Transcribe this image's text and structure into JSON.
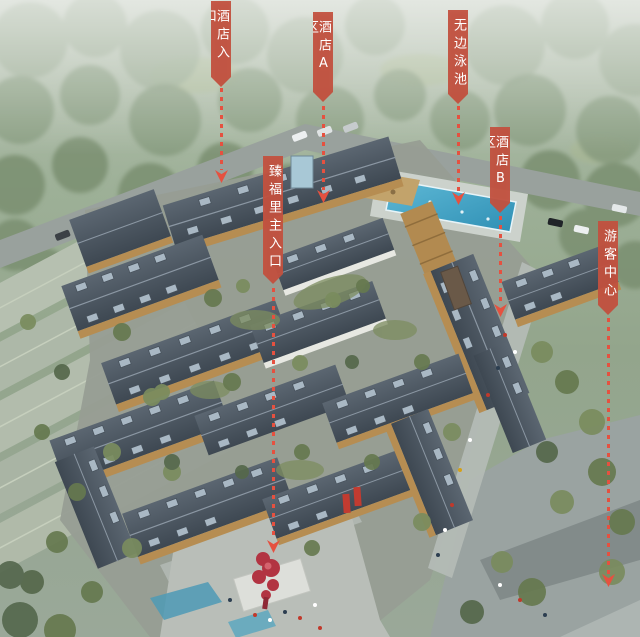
{
  "callouts": [
    {
      "id": "hotel-entrance",
      "label": "酒店入口"
    },
    {
      "id": "hotel-zone-a",
      "label": "酒店A区"
    },
    {
      "id": "infinity-pool",
      "label": "无边泳池"
    },
    {
      "id": "hotel-zone-b",
      "label": "酒店B区"
    },
    {
      "id": "visitor-center",
      "label": "游客中心"
    },
    {
      "id": "zhenfuli-main-entrance",
      "label": "臻福里主入口"
    }
  ],
  "icons": {
    "arrow_down": "▼"
  },
  "colors": {
    "banner_red": "#c45240",
    "arrow_red": "#e55140",
    "label_text": "#ffffff",
    "pool_blue": "#46a6c8",
    "roof_slate": "#49545f",
    "wood_facade": "#b68d52",
    "foliage_green": "#7d9172",
    "sculpture_red": "#b23442"
  }
}
